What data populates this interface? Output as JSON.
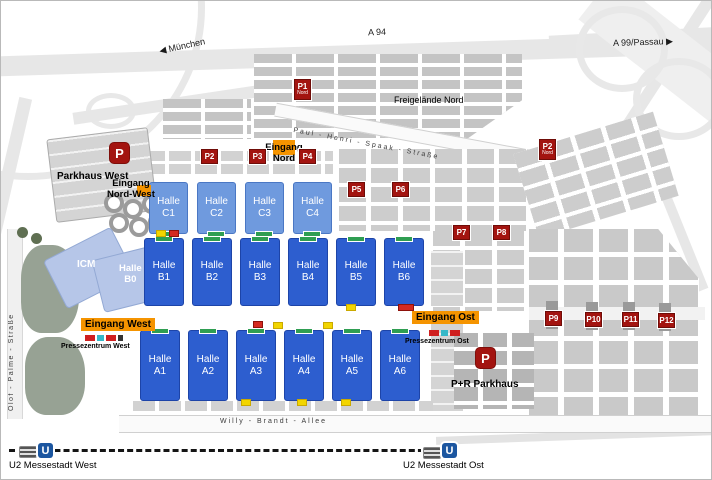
{
  "highways": {
    "muenchen": "München",
    "a94": "A 94",
    "a99": "A 99/Passau",
    "arrow_left": "◀",
    "arrow_right": "▶"
  },
  "streets": {
    "paul_henri_spaak": "Paul - Henri - Spaak - Straße",
    "willy_brandt": "Willy - Brandt - Allee",
    "olof_palme": "Olof - Palme - Straße"
  },
  "areas": {
    "freigelaende_nord": "Freigelände Nord"
  },
  "halls": {
    "icm": {
      "label": "ICM"
    },
    "b0": {
      "line1": "Halle",
      "line2": "B0"
    },
    "c1": {
      "line1": "Halle",
      "line2": "C1"
    },
    "c2": {
      "line1": "Halle",
      "line2": "C2"
    },
    "c3": {
      "line1": "Halle",
      "line2": "C3"
    },
    "c4": {
      "line1": "Halle",
      "line2": "C4"
    },
    "b1": {
      "line1": "Halle",
      "line2": "B1"
    },
    "b2": {
      "line1": "Halle",
      "line2": "B2"
    },
    "b3": {
      "line1": "Halle",
      "line2": "B3"
    },
    "b4": {
      "line1": "Halle",
      "line2": "B4"
    },
    "b5": {
      "line1": "Halle",
      "line2": "B5"
    },
    "b6": {
      "line1": "Halle",
      "line2": "B6"
    },
    "a1": {
      "line1": "Halle",
      "line2": "A1"
    },
    "a2": {
      "line1": "Halle",
      "line2": "A2"
    },
    "a3": {
      "line1": "Halle",
      "line2": "A3"
    },
    "a4": {
      "line1": "Halle",
      "line2": "A4"
    },
    "a5": {
      "line1": "Halle",
      "line2": "A5"
    },
    "a6": {
      "line1": "Halle",
      "line2": "A6"
    }
  },
  "entrances": {
    "nord_west": {
      "line1": "Eingang",
      "line2": "Nord-West"
    },
    "nord": {
      "line1": "Eingang",
      "line2": "Nord"
    },
    "west": {
      "label": "Eingang West"
    },
    "ost": {
      "label": "Eingang Ost"
    }
  },
  "press": {
    "west": "Pressezentrum West",
    "ost": "Pressezentrum Ost"
  },
  "parking": {
    "parkhaus_west": {
      "icon": "P",
      "label": "Parkhaus West"
    },
    "pr_parkhaus": {
      "icon": "P",
      "label": "P+R Parkhaus"
    },
    "p1": {
      "label": "P1",
      "sub": "Nord"
    },
    "p2_west": {
      "label": "P2"
    },
    "p2_nord": {
      "label": "P2",
      "sub": "Nord"
    },
    "p3": {
      "label": "P3"
    },
    "p4": {
      "label": "P4"
    },
    "p5": {
      "label": "P5"
    },
    "p6": {
      "label": "P6"
    },
    "p7": {
      "label": "P7"
    },
    "p8": {
      "label": "P8"
    },
    "p9": {
      "label": "P9"
    },
    "p10": {
      "label": "P10"
    },
    "p11": {
      "label": "P11"
    },
    "p12": {
      "label": "P12"
    }
  },
  "transit": {
    "u_symbol": "U",
    "west": "U2 Messestadt West",
    "ost": "U2 Messestadt Ost"
  },
  "colors": {
    "hall_blue": "#2d5ecf",
    "hall_light_blue": "#6f9ade",
    "hall_pale_blue": "#b6c6e8",
    "parking_red": "#a31410",
    "entrance_orange": "#f59400",
    "ubahn_blue": "#1c56a0",
    "green_marker": "#2f9e52"
  }
}
